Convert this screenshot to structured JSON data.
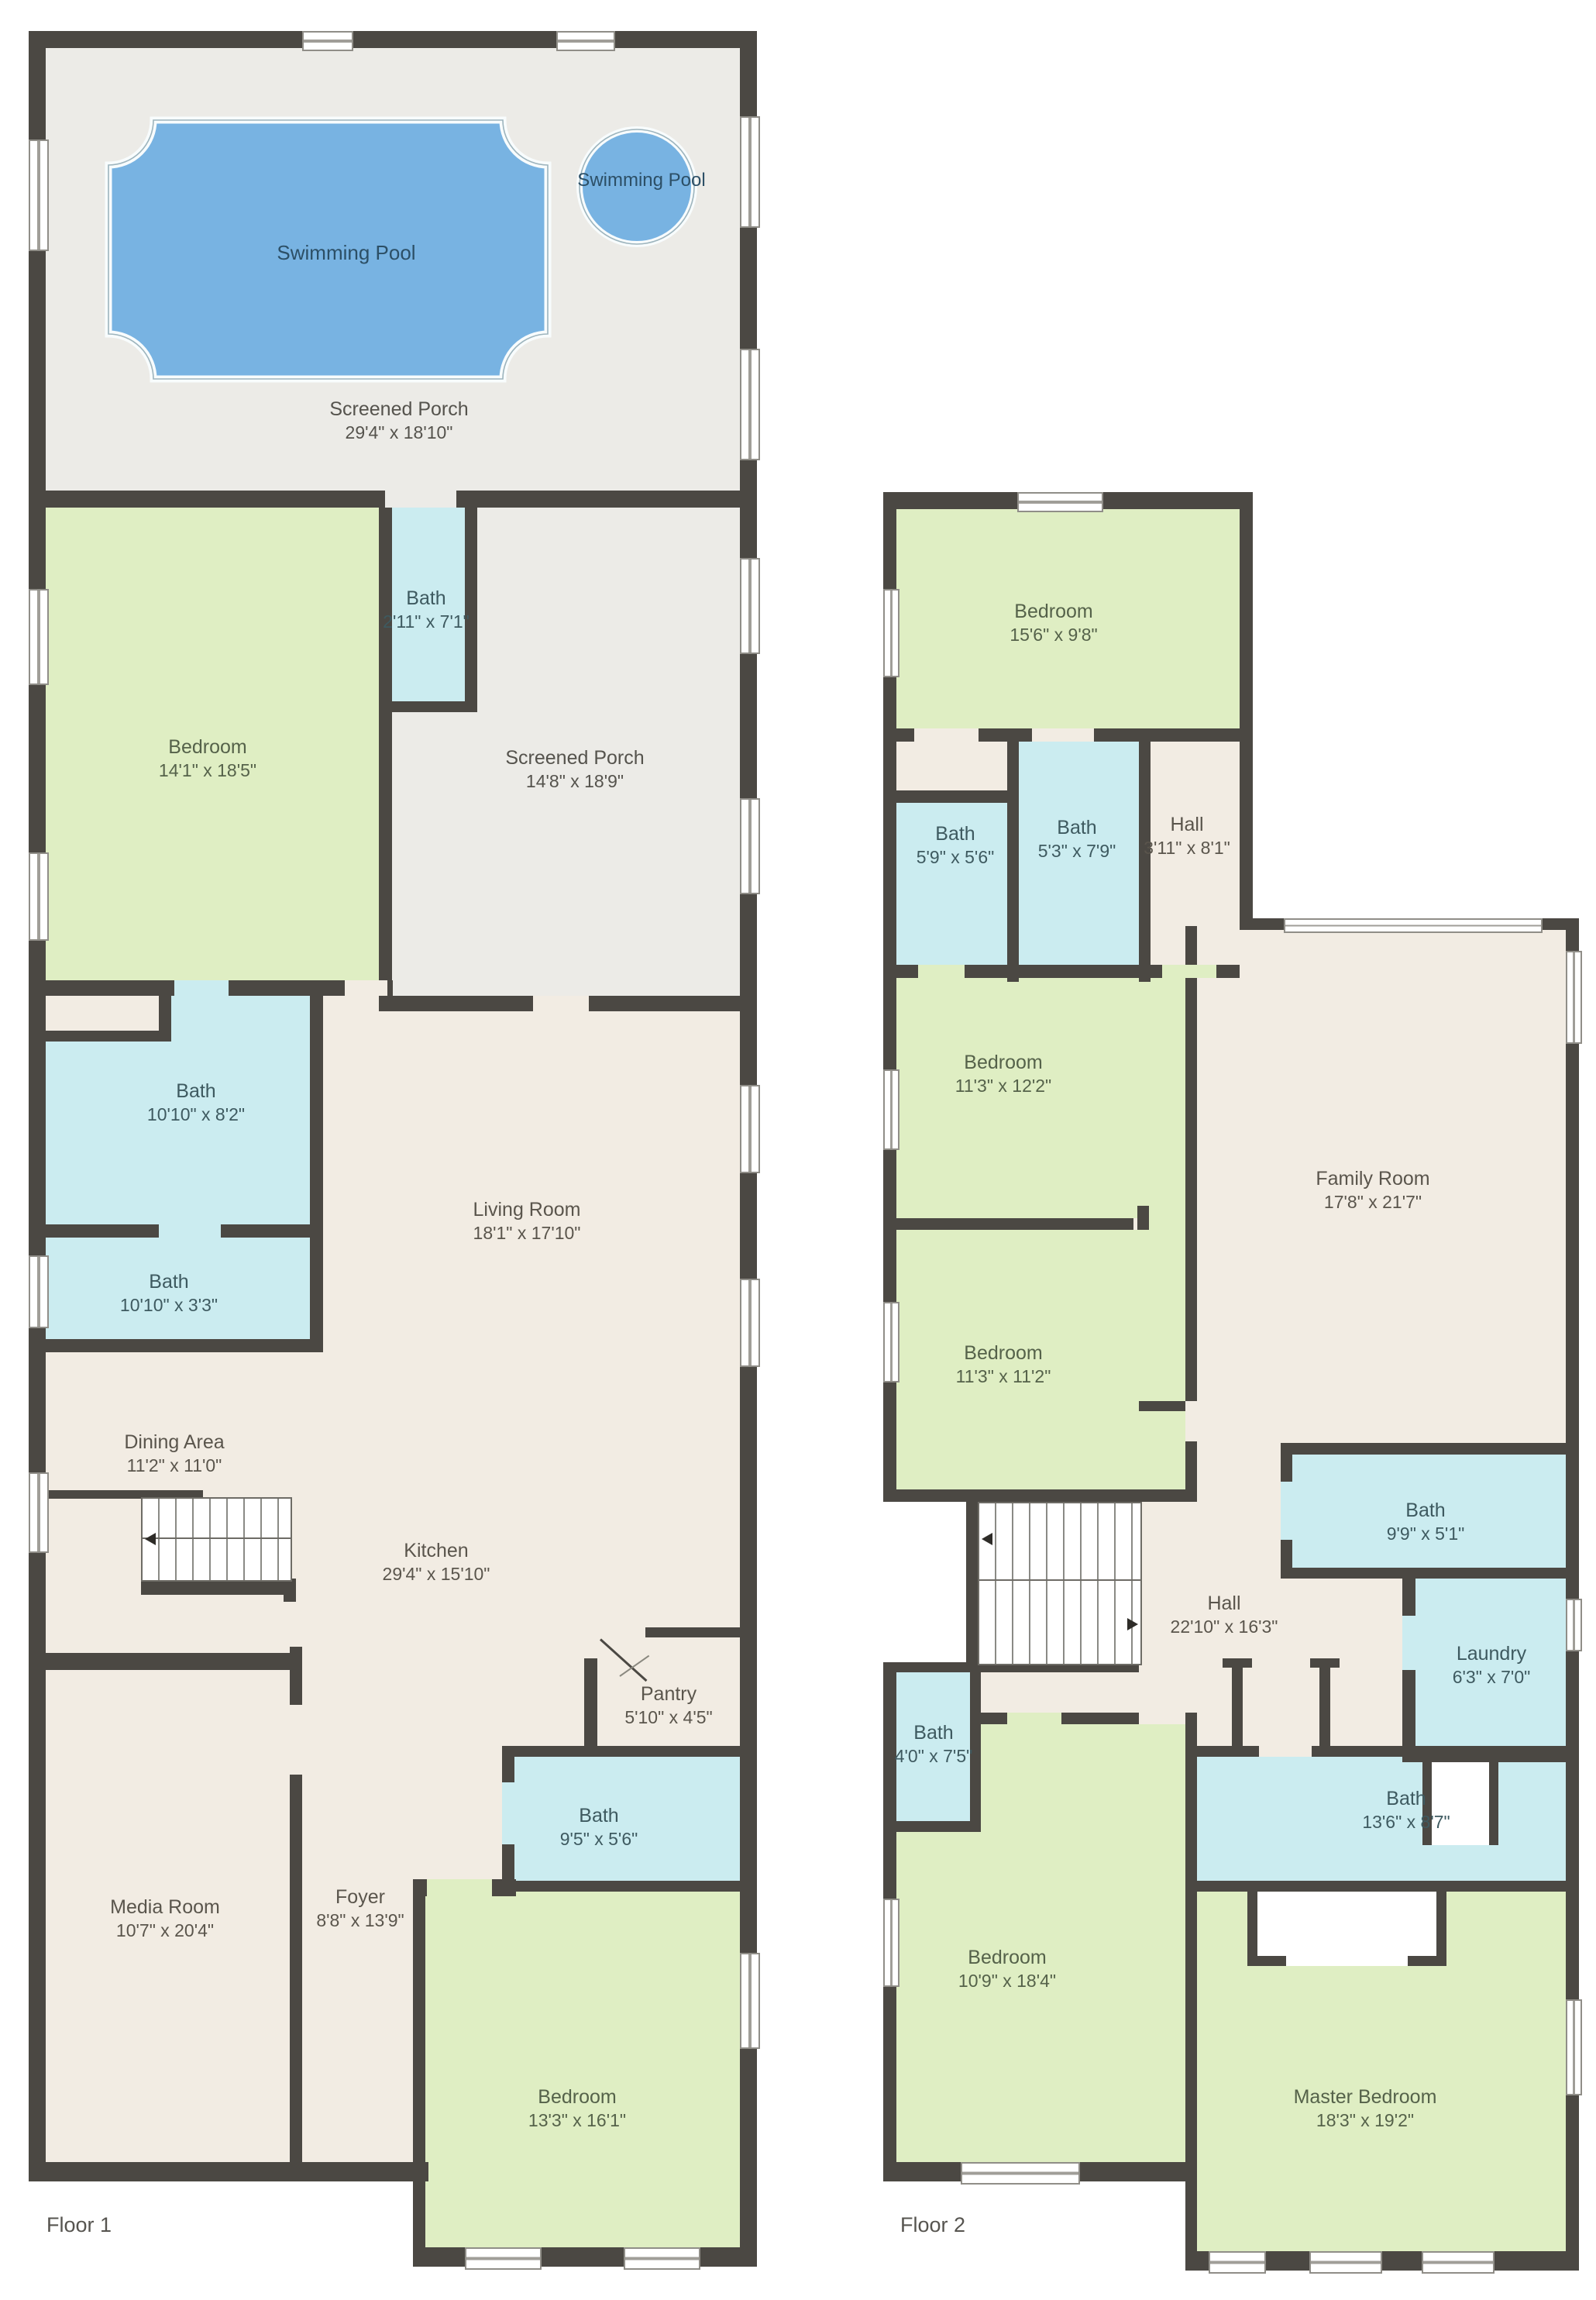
{
  "floor1": {
    "title": "Floor 1",
    "pool": {
      "main_label": "Swimming Pool",
      "spa_label": "Swimming Pool"
    },
    "rooms": [
      {
        "name": "Screened Porch",
        "dims": "29'4\" x 18'10\""
      },
      {
        "name": "Bedroom",
        "dims": "14'1\" x 18'5\""
      },
      {
        "name": "Bath",
        "dims": "2'11\" x 7'1\""
      },
      {
        "name": "Screened Porch",
        "dims": "14'8\" x 18'9\""
      },
      {
        "name": "Bath",
        "dims": "10'10\" x 8'2\""
      },
      {
        "name": "Bath",
        "dims": "10'10\" x 3'3\""
      },
      {
        "name": "Living Room",
        "dims": "18'1\" x 17'10\""
      },
      {
        "name": "Dining Area",
        "dims": "11'2\" x 11'0\""
      },
      {
        "name": "Kitchen",
        "dims": "29'4\" x 15'10\""
      },
      {
        "name": "Pantry",
        "dims": "5'10\" x 4'5\""
      },
      {
        "name": "Bath",
        "dims": "9'5\" x 5'6\""
      },
      {
        "name": "Media Room",
        "dims": "10'7\" x 20'4\""
      },
      {
        "name": "Foyer",
        "dims": "8'8\" x 13'9\""
      },
      {
        "name": "Bedroom",
        "dims": "13'3\" x 16'1\""
      }
    ]
  },
  "floor2": {
    "title": "Floor 2",
    "rooms": [
      {
        "name": "Bedroom",
        "dims": "15'6\" x 9'8\""
      },
      {
        "name": "Bath",
        "dims": "5'9\" x 5'6\""
      },
      {
        "name": "Bath",
        "dims": "5'3\" x 7'9\""
      },
      {
        "name": "Hall",
        "dims": "3'11\" x 8'1\""
      },
      {
        "name": "Bedroom",
        "dims": "11'3\" x 12'2\""
      },
      {
        "name": "Family Room",
        "dims": "17'8\" x 21'7\""
      },
      {
        "name": "Bedroom",
        "dims": "11'3\" x 11'2\""
      },
      {
        "name": "Bath",
        "dims": "9'9\" x 5'1\""
      },
      {
        "name": "Hall",
        "dims": "22'10\" x 16'3\""
      },
      {
        "name": "Laundry",
        "dims": "6'3\" x 7'0\""
      },
      {
        "name": "Bath",
        "dims": "4'0\" x 7'5\""
      },
      {
        "name": "Bath",
        "dims": "13'6\" x 8'7\""
      },
      {
        "name": "Bedroom",
        "dims": "10'9\" x 18'4\""
      },
      {
        "name": "Master Bedroom",
        "dims": "18'3\" x 19'2\""
      }
    ]
  }
}
